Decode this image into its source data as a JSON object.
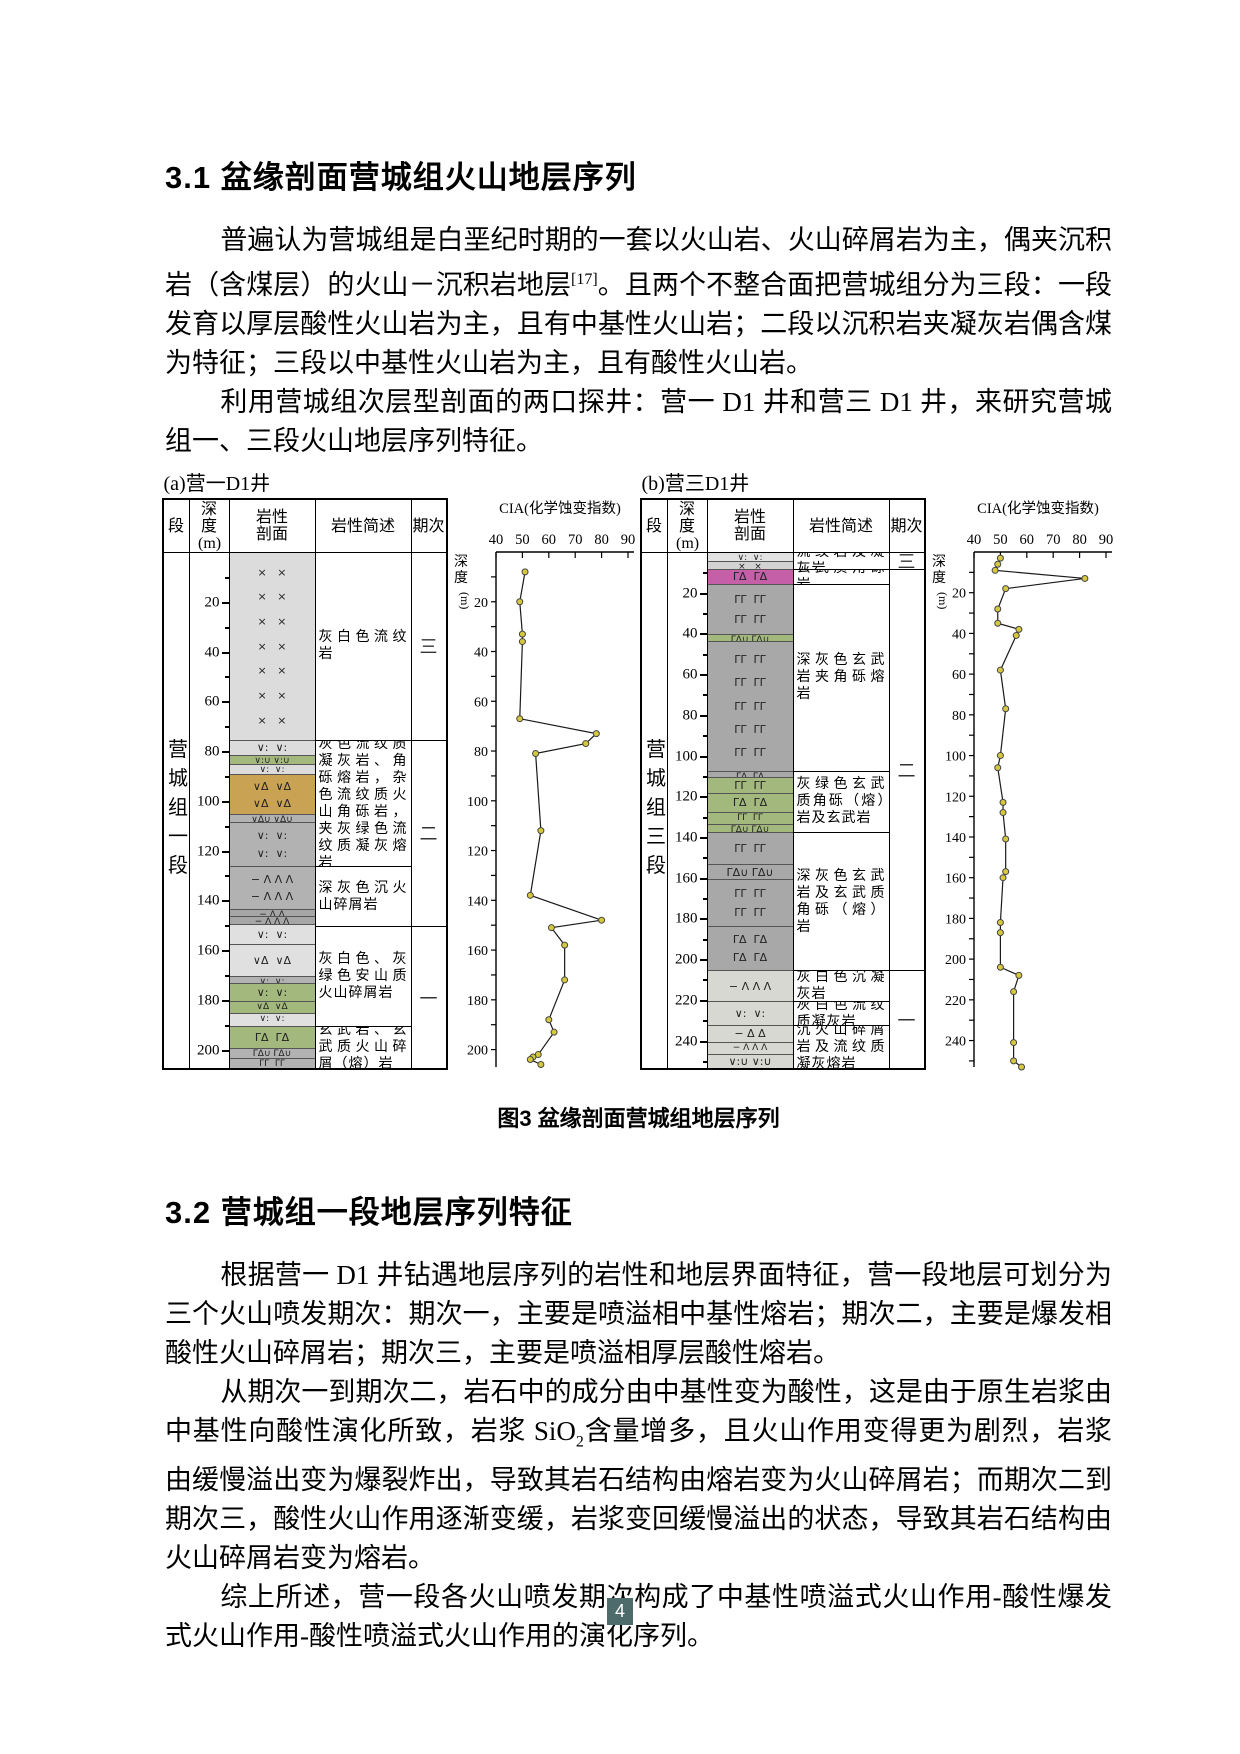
{
  "section1": {
    "heading": "3.1 盆缘剖面营城组火山地层序列",
    "p1_pre": "普遍认为营城组是白垩纪时期的一套以火山岩、火山碎屑岩为主，偶夹沉积岩（含煤层）的火山－沉积岩地层",
    "p1_ref": "[17]",
    "p1_post": "。且两个不整合面把营城组分为三段：一段发育以厚层酸性火山岩为主，且有中基性火山岩；二段以沉积岩夹凝灰岩偶含煤为特征；三段以中基性火山岩为主，且有酸性火山岩。",
    "p2": "利用营城组次层型剖面的两口探井：营一 D1 井和营三 D1 井，来研究营城组一、三段火山地层序列特征。"
  },
  "figure": {
    "caption": "图3 盆缘剖面营城组地层序列",
    "panels": [
      {
        "label": "(a)营一D1井",
        "group_label": "营城组一段",
        "headers": [
          "段",
          "深度(m)",
          "岩性剖面",
          "岩性简述",
          "期次"
        ],
        "max_depth": 207,
        "units": [
          {
            "top": 0,
            "bottom": 75,
            "color": "#dcdcdc",
            "sym": "×   ×"
          },
          {
            "top": 75,
            "bottom": 81,
            "color": "#dcdcdc",
            "sym": "∨:  ∨:"
          },
          {
            "top": 81,
            "bottom": 85,
            "color": "#a2b87c",
            "sym": "∨:∪ ∨:∪"
          },
          {
            "top": 85,
            "bottom": 89,
            "color": "#dcdcdc",
            "sym": "∨:  ∨:"
          },
          {
            "top": 89,
            "bottom": 105,
            "color": "#c9a353",
            "sym": "∨Δ  ∨Δ"
          },
          {
            "top": 105,
            "bottom": 108,
            "color": "#b2b2b2",
            "sym": "∨Δ∪ ∨Δ∪"
          },
          {
            "top": 108,
            "bottom": 126,
            "color": "#b2b2b2",
            "sym": "∨:  ∨:"
          },
          {
            "top": 126,
            "bottom": 143,
            "color": "#b2b2b2",
            "sym": "− Λ Λ Λ"
          },
          {
            "top": 143,
            "bottom": 146,
            "color": "#a6a6a6",
            "sym": "− Δ Δ"
          },
          {
            "top": 146,
            "bottom": 149,
            "color": "#a6a6a6",
            "sym": "− Λ Λ Λ"
          },
          {
            "top": 149,
            "bottom": 157,
            "color": "#e0e0e0",
            "sym": "∨:  ∨:"
          },
          {
            "top": 157,
            "bottom": 170,
            "color": "#e0e0e0",
            "sym": "∨Δ  ∨Δ"
          },
          {
            "top": 170,
            "bottom": 173,
            "color": "#b2b2b2",
            "sym": "∨:  ∨:"
          },
          {
            "top": 173,
            "bottom": 180,
            "color": "#a2b87c",
            "sym": "∨:  ∨:"
          },
          {
            "top": 180,
            "bottom": 185,
            "color": "#a2b87c",
            "sym": "∨Δ  ∨Δ"
          },
          {
            "top": 185,
            "bottom": 190,
            "color": "#e0e0e0",
            "sym": "∨:  ∨:"
          },
          {
            "top": 190,
            "bottom": 199,
            "color": "#a2b87c",
            "sym": "ΓΔ  ΓΔ"
          },
          {
            "top": 199,
            "bottom": 203,
            "color": "#b2b2b2",
            "sym": "ΓΔ∪ ΓΔ∪"
          },
          {
            "top": 203,
            "bottom": 207,
            "color": "#b2b2b2",
            "sym": "ΓΓ  ΓΓ"
          }
        ],
        "descriptions": [
          {
            "top": 0,
            "bottom": 75,
            "text": "灰白色流纹岩"
          },
          {
            "top": 75,
            "bottom": 126,
            "text": "灰色流纹质凝灰岩、角砾熔岩，杂色流纹质火山角砾岩，夹灰绿色流纹质凝灰熔岩"
          },
          {
            "top": 126,
            "bottom": 150,
            "text": "深灰色沉火山碎屑岩"
          },
          {
            "top": 150,
            "bottom": 190,
            "text": "灰白色、灰绿色安山质火山碎屑岩"
          },
          {
            "top": 190,
            "bottom": 207,
            "text": "玄武岩、玄武质火山碎屑（熔）岩"
          }
        ],
        "stages": [
          {
            "top": 0,
            "bottom": 75,
            "label": "三"
          },
          {
            "top": 75,
            "bottom": 150,
            "label": "二"
          },
          {
            "top": 150,
            "bottom": 207,
            "label": "一"
          }
        ]
      },
      {
        "label": "(b)营三D1井",
        "group_label": "营城组三段",
        "headers": [
          "段",
          "深度(m)",
          "岩性剖面",
          "岩性简述",
          "期次"
        ],
        "max_depth": 253,
        "units": [
          {
            "top": 0,
            "bottom": 4,
            "color": "#e2e2e2",
            "sym": "∨:  ∨:"
          },
          {
            "top": 4,
            "bottom": 8,
            "color": "#d2d2d2",
            "sym": "×   ×"
          },
          {
            "top": 8,
            "bottom": 15,
            "color": "#c45fa8",
            "sym": "ΓΔ  ΓΔ"
          },
          {
            "top": 15,
            "bottom": 40,
            "color": "#a8a8a8",
            "sym": "ΓΓ  ΓΓ"
          },
          {
            "top": 40,
            "bottom": 43,
            "color": "#a2b87c",
            "sym": "ΓΔ∪ ΓΔ∪"
          },
          {
            "top": 43,
            "bottom": 107,
            "color": "#a8a8a8",
            "sym": "ΓΓ  ΓΓ"
          },
          {
            "top": 107,
            "bottom": 110,
            "color": "#a8a8a8",
            "sym": "ΓΔ  ΓΔ"
          },
          {
            "top": 110,
            "bottom": 118,
            "color": "#a2b87c",
            "sym": "ΓΓ  ΓΓ"
          },
          {
            "top": 118,
            "bottom": 127,
            "color": "#a2b87c",
            "sym": "ΓΔ  ΓΔ"
          },
          {
            "top": 127,
            "bottom": 133,
            "color": "#a2b87c",
            "sym": "ΓΓ  ΓΓ"
          },
          {
            "top": 133,
            "bottom": 137,
            "color": "#a2b87c",
            "sym": "ΓΔ∪ ΓΔ∪"
          },
          {
            "top": 137,
            "bottom": 153,
            "color": "#a8a8a8",
            "sym": "ΓΓ  ΓΓ"
          },
          {
            "top": 153,
            "bottom": 160,
            "color": "#a8a8a8",
            "sym": "ΓΔ∪ ΓΔ∪"
          },
          {
            "top": 160,
            "bottom": 183,
            "color": "#a8a8a8",
            "sym": "ΓΓ  ΓΓ"
          },
          {
            "top": 183,
            "bottom": 205,
            "color": "#a8a8a8",
            "sym": "ΓΔ  ΓΔ"
          },
          {
            "top": 205,
            "bottom": 220,
            "color": "#d8d8d2",
            "sym": "− Λ Λ Λ"
          },
          {
            "top": 220,
            "bottom": 232,
            "color": "#d8d8d2",
            "sym": "∨:  ∨:"
          },
          {
            "top": 232,
            "bottom": 240,
            "color": "#d8d8d2",
            "sym": "− Δ Δ"
          },
          {
            "top": 240,
            "bottom": 246,
            "color": "#d8d8d2",
            "sym": "− Λ Λ Λ"
          },
          {
            "top": 246,
            "bottom": 253,
            "color": "#d8d8d2",
            "sym": "∨:∪ ∨:∪"
          }
        ],
        "descriptions": [
          {
            "top": 0,
            "bottom": 8,
            "text": "流纹岩及凝灰岩"
          },
          {
            "top": 8,
            "bottom": 15,
            "text": "玄武质角砾岩"
          },
          {
            "top": 15,
            "bottom": 107,
            "text": "深灰色玄武岩夹角砾熔岩"
          },
          {
            "top": 107,
            "bottom": 137,
            "text": "灰绿色玄武质角砾（熔）岩及玄武岩"
          },
          {
            "top": 137,
            "bottom": 205,
            "text": "深灰色玄武岩及玄武质角砾（熔）岩"
          },
          {
            "top": 205,
            "bottom": 220,
            "text": "灰白色沉凝灰岩"
          },
          {
            "top": 220,
            "bottom": 232,
            "text": "灰白色流纹质凝灰岩"
          },
          {
            "top": 232,
            "bottom": 253,
            "text": "沉火山碎屑岩及流纹质凝灰熔岩"
          }
        ],
        "stages": [
          {
            "top": 0,
            "bottom": 8,
            "label": "三"
          },
          {
            "top": 8,
            "bottom": 205,
            "label": "二"
          },
          {
            "top": 205,
            "bottom": 253,
            "label": "一"
          }
        ]
      }
    ]
  },
  "chart_data": [
    {
      "type": "line",
      "title": "CIA(化学蚀变指数)",
      "well": "营一D1井",
      "xlabel": "CIA",
      "ylabel": "深度(m)",
      "xlim": [
        40,
        90
      ],
      "xticks": [
        40,
        50,
        60,
        70,
        80,
        90
      ],
      "ylim": [
        0,
        207
      ],
      "depth_label_step": 20,
      "points_depth_cia": [
        [
          8,
          51
        ],
        [
          20,
          49
        ],
        [
          33,
          50
        ],
        [
          36,
          50
        ],
        [
          67,
          49
        ],
        [
          73,
          78
        ],
        [
          77,
          74
        ],
        [
          81,
          55
        ],
        [
          112,
          57
        ],
        [
          138,
          53
        ],
        [
          148,
          80
        ],
        [
          151,
          61
        ],
        [
          158,
          66
        ],
        [
          172,
          66
        ],
        [
          188,
          60
        ],
        [
          193,
          62
        ],
        [
          202,
          56
        ],
        [
          203,
          54
        ],
        [
          204,
          53
        ],
        [
          206,
          57
        ]
      ],
      "marker_color": "#d6c83e",
      "line_color": "#1a1a1a"
    },
    {
      "type": "line",
      "title": "CIA(化学蚀变指数)",
      "well": "营三D1井",
      "xlabel": "CIA",
      "ylabel": "深度(m)",
      "xlim": [
        40,
        90
      ],
      "xticks": [
        40,
        50,
        60,
        70,
        80,
        90
      ],
      "ylim": [
        0,
        253
      ],
      "depth_label_step": 20,
      "points_depth_cia": [
        [
          3,
          50
        ],
        [
          6,
          49
        ],
        [
          9,
          48
        ],
        [
          13,
          82
        ],
        [
          18,
          52
        ],
        [
          28,
          49
        ],
        [
          35,
          49
        ],
        [
          38,
          57
        ],
        [
          41,
          56
        ],
        [
          58,
          50
        ],
        [
          77,
          52
        ],
        [
          100,
          50
        ],
        [
          106,
          49
        ],
        [
          123,
          51
        ],
        [
          128,
          51
        ],
        [
          141,
          52
        ],
        [
          157,
          52
        ],
        [
          160,
          51
        ],
        [
          182,
          50
        ],
        [
          187,
          50
        ],
        [
          204,
          50
        ],
        [
          208,
          57
        ],
        [
          216,
          55
        ],
        [
          241,
          55
        ],
        [
          250,
          55
        ],
        [
          253,
          58
        ]
      ],
      "marker_color": "#d6c83e",
      "line_color": "#1a1a1a"
    }
  ],
  "section2": {
    "heading": "3.2 营城组一段地层序列特征",
    "p1": "根据营一 D1 井钻遇地层序列的岩性和地层界面特征，营一段地层可划分为三个火山喷发期次：期次一，主要是喷溢相中基性熔岩；期次二，主要是爆发相酸性火山碎屑岩；期次三，主要是喷溢相厚层酸性熔岩。",
    "p2_pre": "从期次一到期次二，岩石中的成分由中基性变为酸性，这是由于原生岩浆由中基性向酸性演化所致，岩浆 SiO",
    "p2_sub": "2",
    "p2_post": "含量增多，且火山作用变得更为剧烈，岩浆由缓慢溢出变为爆裂炸出，导致其岩石结构由熔岩变为火山碎屑岩；而期次二到期次三，酸性火山作用逐渐变缓，岩浆变回缓慢溢出的状态，导致其岩石结构由火山碎屑岩变为熔岩。",
    "p3": "综上所述，营一段各火山喷发期次构成了中基性喷溢式火山作用-酸性爆发式火山作用-酸性喷溢式火山作用的演化序列。"
  },
  "page_number": "4"
}
